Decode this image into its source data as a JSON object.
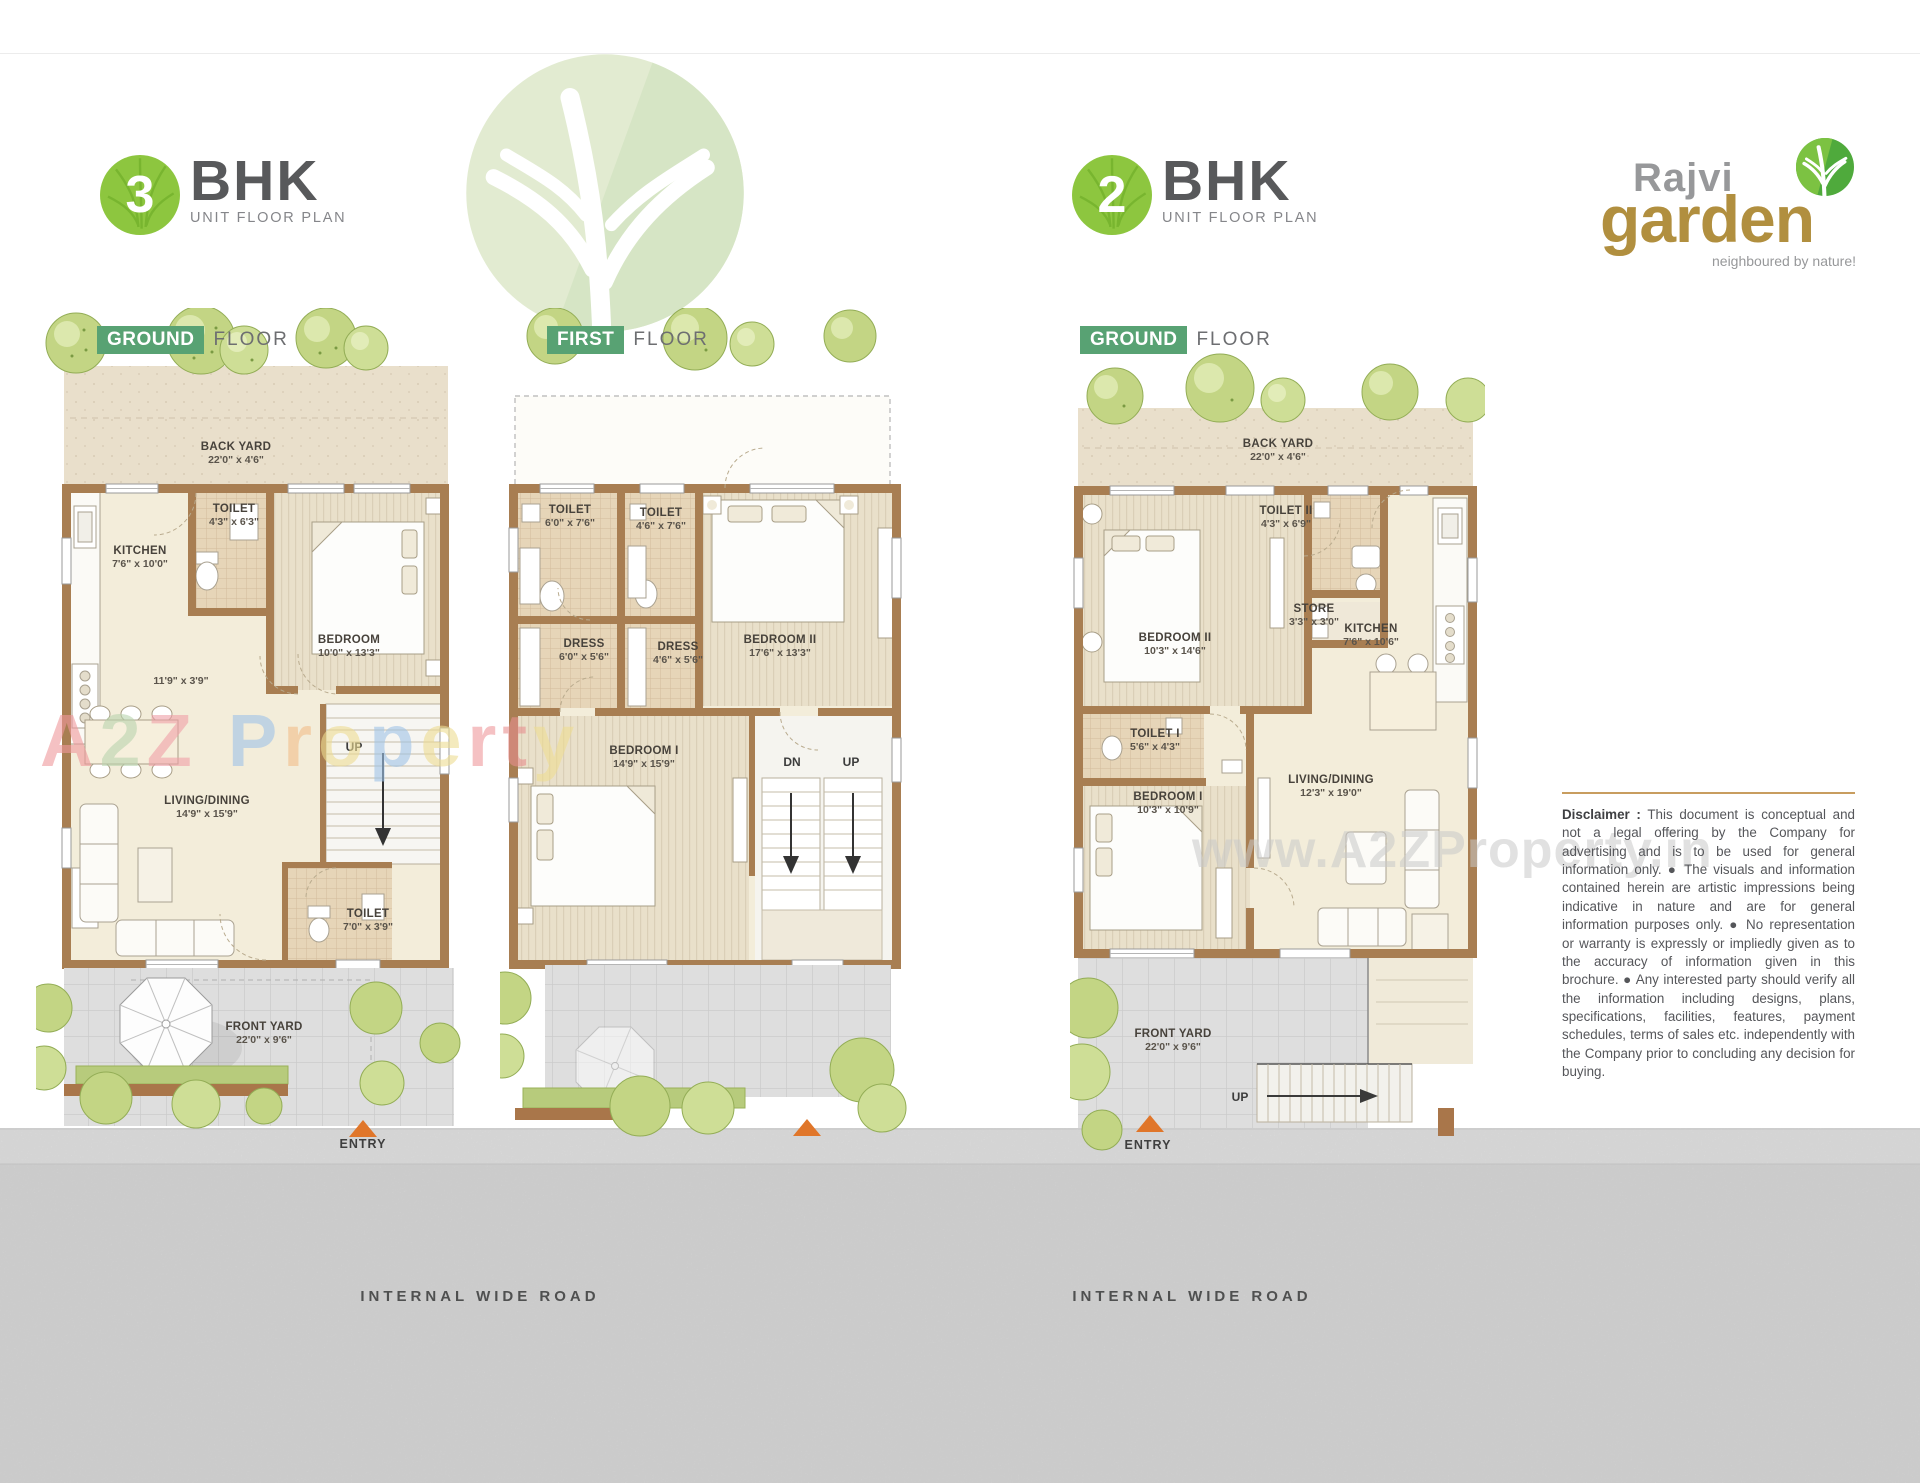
{
  "badges": [
    {
      "number": "3",
      "label": "BHK",
      "sublabel": "UNIT FLOOR PLAN"
    },
    {
      "number": "2",
      "label": "BHK",
      "sublabel": "UNIT FLOOR PLAN"
    }
  ],
  "logo": {
    "brand_top": "Rajvi",
    "brand_main": "garden",
    "tagline": "neighboured by nature!"
  },
  "floor_labels": [
    {
      "tag": "GROUND",
      "word": "FLOOR"
    },
    {
      "tag": "FIRST",
      "word": "FLOOR"
    },
    {
      "tag": "GROUND",
      "word": "FLOOR"
    }
  ],
  "plans": [
    {
      "title": "3 BHK Ground Floor",
      "rooms": [
        {
          "name": "BACK YARD",
          "dims": "22'0\" x 4'6\""
        },
        {
          "name": "TOILET",
          "dims": "4'3\" x 6'3\""
        },
        {
          "name": "KITCHEN",
          "dims": "7'6\" x 10'0\""
        },
        {
          "name": "BEDROOM",
          "dims": "10'0\" x 13'3\""
        },
        {
          "name": "",
          "dims": "11'9\" x 3'9\""
        },
        {
          "name": "LIVING/DINING",
          "dims": "14'9\" x 15'9\""
        },
        {
          "name": "TOILET",
          "dims": "7'0\" x 3'9\""
        },
        {
          "name": "FRONT YARD",
          "dims": "22'0\" x 9'6\""
        }
      ],
      "stair_labels": {
        "up": "UP"
      },
      "entry_label": "ENTRY"
    },
    {
      "title": "3 BHK First Floor",
      "rooms": [
        {
          "name": "TOILET",
          "dims": "6'0\" x 7'6\""
        },
        {
          "name": "TOILET",
          "dims": "4'6\" x 7'6\""
        },
        {
          "name": "BEDROOM II",
          "dims": "17'6\" x 13'3\""
        },
        {
          "name": "DRESS",
          "dims": "6'0\" x 5'6\""
        },
        {
          "name": "DRESS",
          "dims": "4'6\" x 5'6\""
        },
        {
          "name": "BEDROOM I",
          "dims": "14'9\" x 15'9\""
        }
      ],
      "stair_labels": {
        "dn": "DN",
        "up": "UP"
      }
    },
    {
      "title": "2 BHK Ground Floor",
      "rooms": [
        {
          "name": "BACK YARD",
          "dims": "22'0\" x 4'6\""
        },
        {
          "name": "TOILET II",
          "dims": "4'3\" x 6'9\""
        },
        {
          "name": "BEDROOM II",
          "dims": "10'3\" x 14'6\""
        },
        {
          "name": "STORE",
          "dims": "3'3\" x 3'0\""
        },
        {
          "name": "KITCHEN",
          "dims": "7'6\" x 10'6\""
        },
        {
          "name": "TOILET I",
          "dims": "5'6\" x 4'3\""
        },
        {
          "name": "BEDROOM I",
          "dims": "10'3\" x 10'9\""
        },
        {
          "name": "LIVING/DINING",
          "dims": "12'3\" x 19'0\""
        },
        {
          "name": "FRONT YARD",
          "dims": "22'0\" x 9'6\""
        }
      ],
      "stair_labels": {
        "up": "UP"
      },
      "entry_label": "ENTRY"
    }
  ],
  "watermarks": {
    "a2z": {
      "text": "A2Z Property",
      "letters": [
        {
          "ch": "A"
        },
        {
          "ch": "2"
        },
        {
          "ch": "Z"
        },
        {
          "ch": "P"
        },
        {
          "ch": "r"
        },
        {
          "ch": "o"
        },
        {
          "ch": "p"
        },
        {
          "ch": "e"
        },
        {
          "ch": "r"
        },
        {
          "ch": "t"
        },
        {
          "ch": "y"
        }
      ]
    },
    "web": {
      "text": "www.A2ZProperty.in"
    }
  },
  "disclaimer": {
    "label": "Disclaimer :",
    "body": " This document is conceptual and not a legal offering by the Company for advertising and is to be used for general information only. ● The visuals and information contained herein are artistic impressions being indicative in nature and are for general information purposes only. ● No representation or warranty is expressly or impliedly given as to the accuracy of information given in this brochure. ● Any interested party should verify all the information including designs, plans, specifications, facilities, features, payment schedules, terms of sales etc. independently with the Company prior to concluding any decision for buying."
  },
  "road": {
    "label_left": "INTERNAL WIDE ROAD",
    "label_right": "INTERNAL WIDE ROAD"
  },
  "colors": {
    "badge_green": "#8dc63f",
    "tag_green": "#58a273",
    "text_gray": "#58595b",
    "logo_gold": "#b18f3f",
    "logo_gray": "#97989a",
    "wall_brown": "#a87e52",
    "floor_cream": "#f3edda",
    "toilet_tan": "#e6d5b8",
    "yard_beige": "#e9dfcb",
    "paver_gray": "#dedede",
    "road_gray": "#d8d8d8",
    "entry_orange": "#e0762a",
    "tree_green": "#c3d584",
    "disclaimer_rule_gold": "#c89d5f"
  }
}
